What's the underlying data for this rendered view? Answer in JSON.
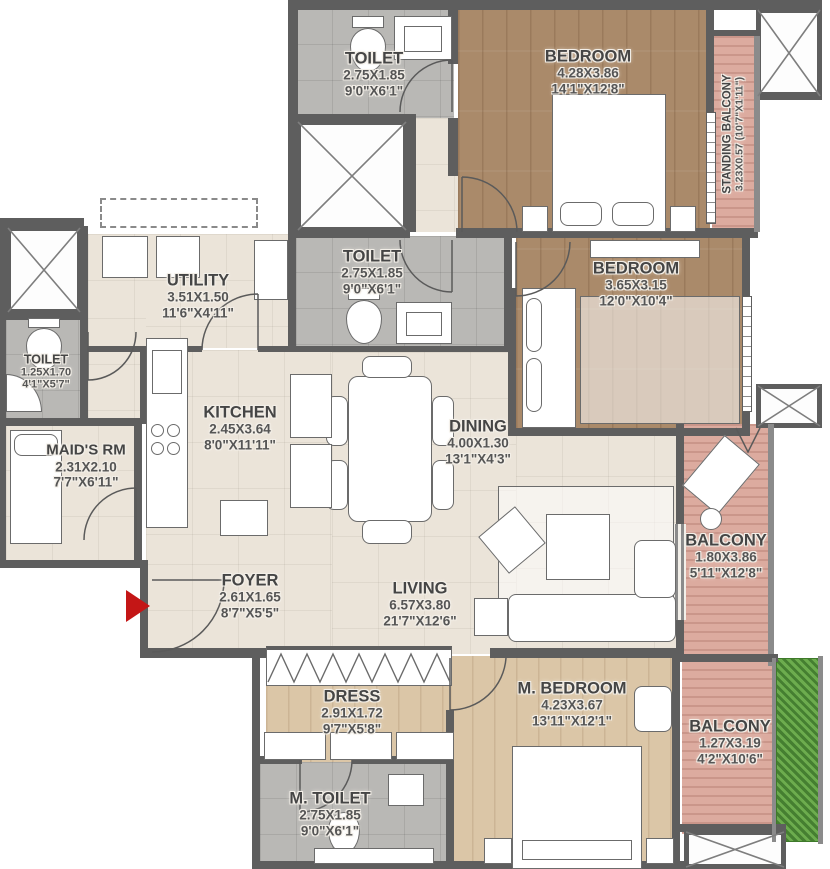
{
  "rooms": {
    "toilet_top": {
      "name": "TOILET",
      "dim_m": "2.75X1.85",
      "dim_ft": "9'0\"X6'1\""
    },
    "bedroom_1": {
      "name": "BEDROOM",
      "dim_m": "4.28X3.86",
      "dim_ft": "14'1\"X12'8\""
    },
    "standing_balcony": {
      "name": "STANDING BALCONY",
      "dim": "3.23X0.57 (10'7\"X1'11\")"
    },
    "toilet_mid": {
      "name": "TOILET",
      "dim_m": "2.75X1.85",
      "dim_ft": "9'0\"X6'1\""
    },
    "bedroom_2": {
      "name": "BEDROOM",
      "dim_m": "3.65X3.15",
      "dim_ft": "12'0\"X10'4\""
    },
    "utility": {
      "name": "UTILITY",
      "dim_m": "3.51X1.50",
      "dim_ft": "11'6\"X4'11\""
    },
    "toilet_left": {
      "name": "TOILET",
      "dim_m": "1.25X1.70",
      "dim_ft": "4'1\"X5'7\""
    },
    "maids_room": {
      "name": "MAID'S RM",
      "dim_m": "2.31X2.10",
      "dim_ft": "7'7\"X6'11\""
    },
    "kitchen": {
      "name": "KITCHEN",
      "dim_m": "2.45X3.64",
      "dim_ft": "8'0\"X11'11\""
    },
    "dining": {
      "name": "DINING",
      "dim_m": "4.00X1.30",
      "dim_ft": "13'1\"X4'3\""
    },
    "balcony_right": {
      "name": "BALCONY",
      "dim_m": "1.80X3.86",
      "dim_ft": "5'11\"X12'8\""
    },
    "foyer": {
      "name": "FOYER",
      "dim_m": "2.61X1.65",
      "dim_ft": "8'7\"X5'5\""
    },
    "living": {
      "name": "LIVING",
      "dim_m": "6.57X3.80",
      "dim_ft": "21'7\"X12'6\""
    },
    "dress": {
      "name": "DRESS",
      "dim_m": "2.91X1.72",
      "dim_ft": "9'7\"X5'8\""
    },
    "m_bedroom": {
      "name": "M. BEDROOM",
      "dim_m": "4.23X3.67",
      "dim_ft": "13'11\"X12'1\""
    },
    "m_toilet": {
      "name": "M. TOILET",
      "dim_m": "2.75X1.85",
      "dim_ft": "9'0\"X6'1\""
    },
    "balcony_bottom": {
      "name": "BALCONY",
      "dim_m": "1.27X3.19",
      "dim_ft": "4'2\"X10'6\""
    }
  },
  "colors": {
    "wall": "#5e5e5e",
    "wood_dark": "#aa8a6a",
    "wood_light": "#dbc6a7",
    "tile_gray": "#b9b8b5",
    "floor_cream": "#ebe4d9",
    "balcony_pink": "#dcab9f",
    "planter_green": "#5f9c44",
    "entry_arrow": "#c41616",
    "label_text": "#454545"
  }
}
